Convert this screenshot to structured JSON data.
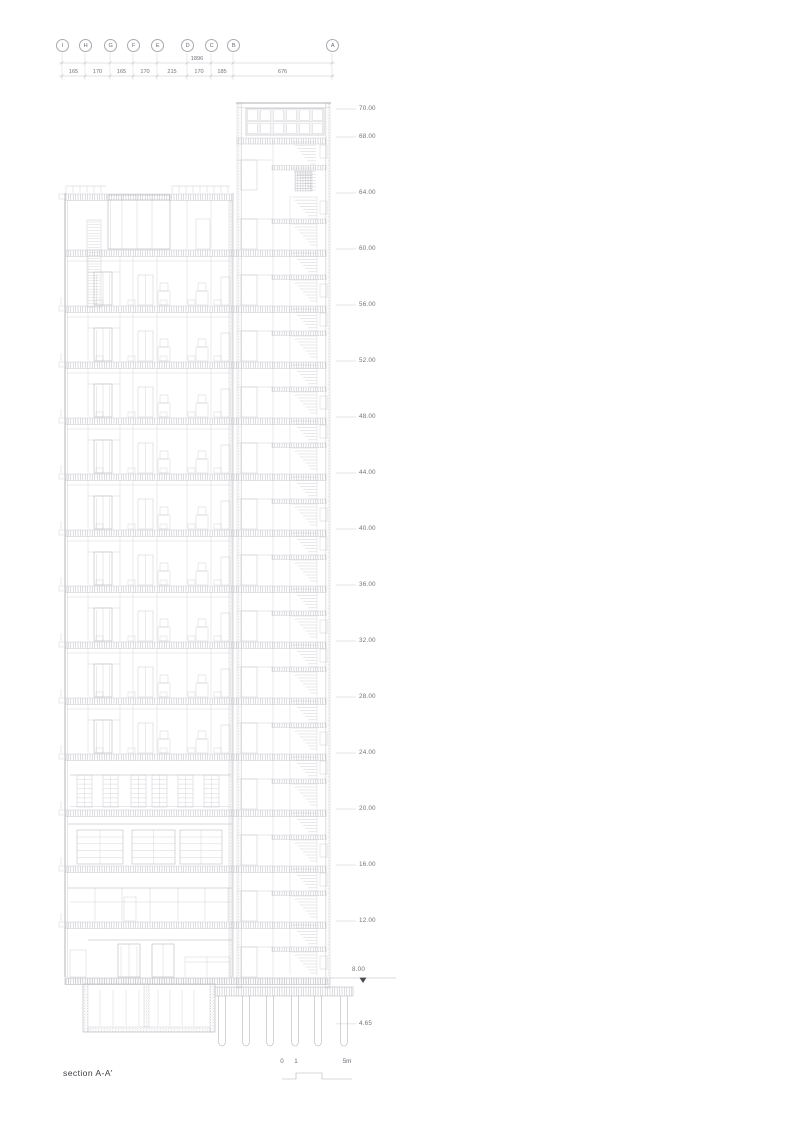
{
  "title": "section A-A'",
  "grid": {
    "markers": [
      "I",
      "H",
      "G",
      "F",
      "E",
      "D",
      "C",
      "B",
      "A"
    ]
  },
  "dimensions": {
    "total": "1896",
    "segments": [
      "165",
      "170",
      "165",
      "170",
      "215",
      "170",
      "185",
      "676"
    ]
  },
  "levels": {
    "items": [
      "70.00",
      "68.00",
      "64.00",
      "60.00",
      "56.00",
      "52.00",
      "48.00",
      "44.00",
      "40.00",
      "36.00",
      "32.00",
      "28.00",
      "24.00",
      "20.00",
      "16.00",
      "12.00"
    ],
    "ground": "8.00",
    "foundation": "4.65"
  },
  "scalebar": {
    "labels": [
      "0",
      "1",
      "5m"
    ]
  },
  "colors": {
    "ink_strong": "#98989e",
    "ink_mid": "#b2b2b8",
    "ink_light": "#c6c6cc",
    "text": "#72727c",
    "marker": "#4a4a50",
    "background": "#ffffff"
  }
}
